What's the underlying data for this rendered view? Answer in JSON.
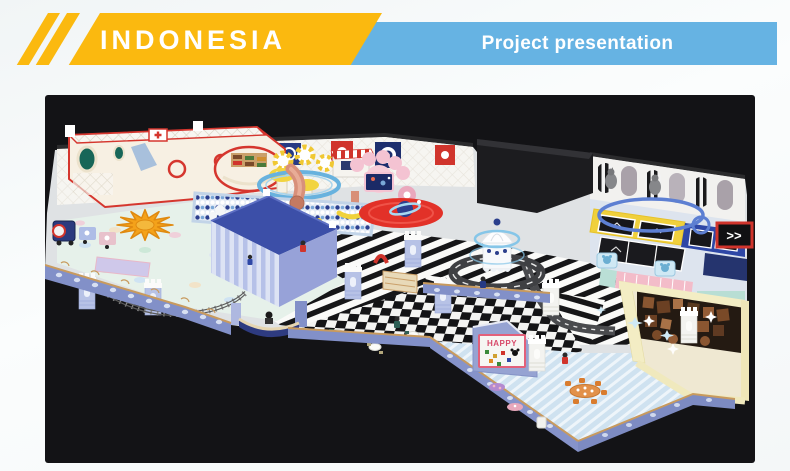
{
  "header": {
    "title": "INDONESIA",
    "subtitle": "Project presentation"
  },
  "palette": {
    "banner_yellow": "#fbb90f",
    "banner_blue": "#66b3e3",
    "panel_bg": "#131316",
    "playhouse_red": "#d5362e",
    "structure_blue": "#3c4fa8",
    "floor_mint": "#e6f1ea",
    "party_floor_blue": "#cfe2f0",
    "room_yellow": "#f3edc4",
    "starburst_orange": "#f4a21a"
  },
  "scene": {
    "happy_sign": "HAPPY",
    "arrow_sign": ">>"
  }
}
